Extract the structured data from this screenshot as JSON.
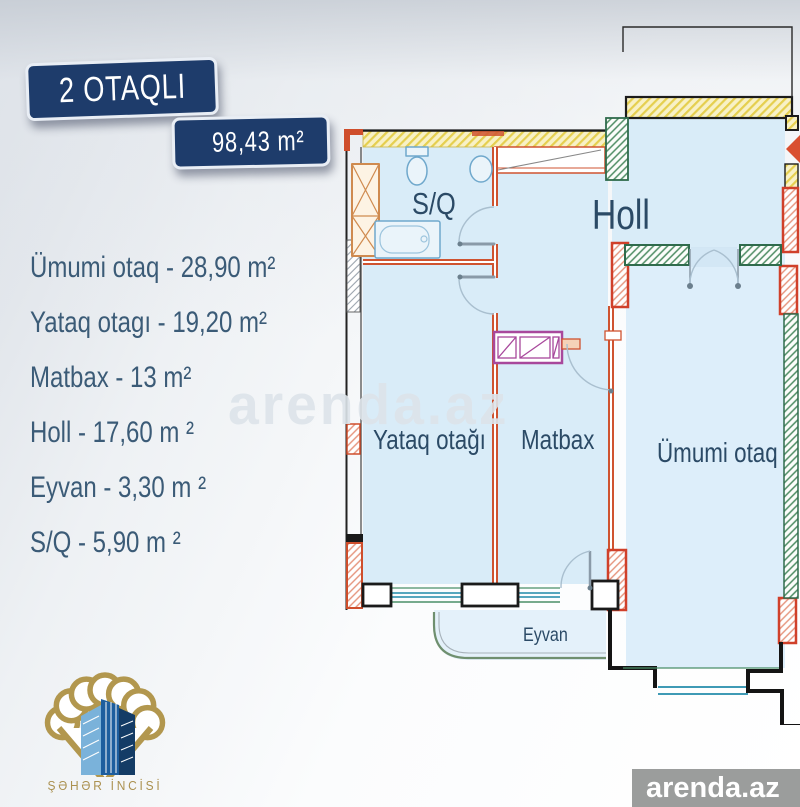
{
  "header": {
    "rooms_badge": "2 OTAQLI",
    "area_badge": "98,43 m²"
  },
  "room_list": [
    "Ümumi otaq - 28,90 m²",
    "Yataq otagı - 19,20 m²",
    "Matbax - 13 m²",
    "Holl - 17,60 m ²",
    "Eyvan - 3,30 m ²",
    "S/Q - 5,90 m ²"
  ],
  "plan_labels": {
    "bathroom": "S/Q",
    "hall": "Holl",
    "bedroom": "Yataq otağı",
    "kitchen": "Matbax",
    "living": "Ümumi otaq",
    "balcony": "Eyvan"
  },
  "watermark": "arenda.az",
  "logo": {
    "title": "ŞƏHƏR İNCİSİ"
  },
  "footer": {
    "brand": "arenda.az"
  },
  "colors": {
    "badge_navy": "#1e3c6b",
    "list_text": "#3b5b77",
    "plan_floor": "#d9ecf8",
    "wall_orange": "#cf5330",
    "wall_green": "#2f6b4c",
    "wall_yellow_hatch": "#e5cf4f",
    "kitchen_magenta": "#a8489c",
    "fixture_blue": "#6fa8cc",
    "logo_gold": "#ab9150",
    "footer_gray": "#9b9d9c",
    "entrance_arrow": "#d94f30"
  }
}
